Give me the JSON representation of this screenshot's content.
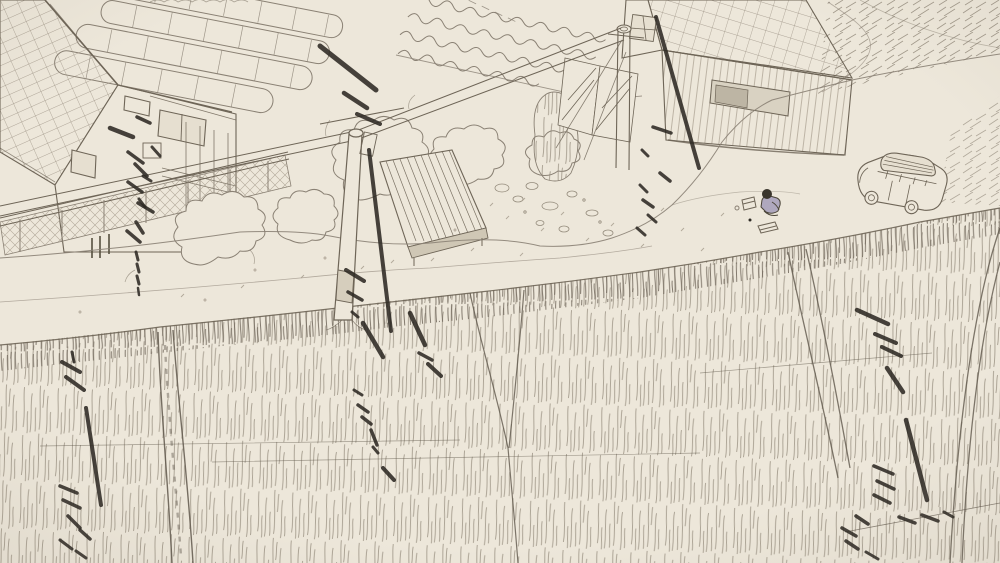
{
  "scene": {
    "style": "monochrome pencil sketch, aerial three-quarter view",
    "objects": [
      "farmhouse-with-tiled-roof",
      "greenhouse-tunnels",
      "vegetable-garden",
      "chain-link-fence",
      "trees",
      "utility-pole-center",
      "utility-pole-right",
      "power-lines",
      "plank-sided-house",
      "wooden-shed",
      "gravel-road",
      "parked-car",
      "sitting-person",
      "rice-fields",
      "dry-field",
      "cicada-sound-marks"
    ]
  },
  "palette": {
    "paper": "#ede7da",
    "ink": "#8a8174",
    "ink_soft": "#a79d8e",
    "ink_dark": "#6e6557",
    "ink_bold": "#2e2a24",
    "figure_accent": "#7b74a8"
  },
  "sound_marks": [
    {
      "x1": 320,
      "y1": 46,
      "x2": 376,
      "y2": 90,
      "w": 5
    },
    {
      "x1": 344,
      "y1": 93,
      "x2": 367,
      "y2": 108,
      "w": 4.5
    },
    {
      "x1": 357,
      "y1": 114,
      "x2": 380,
      "y2": 124,
      "w": 4
    },
    {
      "x1": 369,
      "y1": 150,
      "x2": 391,
      "y2": 331,
      "w": 4
    },
    {
      "x1": 346,
      "y1": 270,
      "x2": 364,
      "y2": 281,
      "w": 4
    },
    {
      "x1": 348,
      "y1": 292,
      "x2": 362,
      "y2": 300,
      "w": 3.5
    },
    {
      "x1": 352,
      "y1": 312,
      "x2": 358,
      "y2": 317,
      "w": 3
    },
    {
      "x1": 110,
      "y1": 128,
      "x2": 133,
      "y2": 137,
      "w": 4.5
    },
    {
      "x1": 137,
      "y1": 117,
      "x2": 150,
      "y2": 123,
      "w": 3.5
    },
    {
      "x1": 128,
      "y1": 152,
      "x2": 143,
      "y2": 163,
      "w": 3.5
    },
    {
      "x1": 152,
      "y1": 147,
      "x2": 160,
      "y2": 156,
      "w": 3
    },
    {
      "x1": 135,
      "y1": 164,
      "x2": 147,
      "y2": 176,
      "w": 3.5
    },
    {
      "x1": 143,
      "y1": 176,
      "x2": 151,
      "y2": 181,
      "w": 3
    },
    {
      "x1": 128,
      "y1": 182,
      "x2": 142,
      "y2": 192,
      "w": 3.5
    },
    {
      "x1": 139,
      "y1": 199,
      "x2": 145,
      "y2": 207,
      "w": 3
    },
    {
      "x1": 138,
      "y1": 203,
      "x2": 153,
      "y2": 212,
      "w": 3.5
    },
    {
      "x1": 136,
      "y1": 222,
      "x2": 143,
      "y2": 233,
      "w": 3.5
    },
    {
      "x1": 127,
      "y1": 231,
      "x2": 140,
      "y2": 242,
      "w": 3.5
    },
    {
      "x1": 136,
      "y1": 252,
      "x2": 138,
      "y2": 260,
      "w": 3
    },
    {
      "x1": 137,
      "y1": 264,
      "x2": 139,
      "y2": 272,
      "w": 3
    },
    {
      "x1": 137,
      "y1": 276,
      "x2": 139,
      "y2": 284,
      "w": 3
    },
    {
      "x1": 138,
      "y1": 288,
      "x2": 139,
      "y2": 295,
      "w": 2.5
    },
    {
      "x1": 656,
      "y1": 17,
      "x2": 699,
      "y2": 168,
      "w": 4
    },
    {
      "x1": 653,
      "y1": 127,
      "x2": 671,
      "y2": 133,
      "w": 3.5
    },
    {
      "x1": 642,
      "y1": 150,
      "x2": 648,
      "y2": 156,
      "w": 3
    },
    {
      "x1": 660,
      "y1": 173,
      "x2": 670,
      "y2": 181,
      "w": 3.5
    },
    {
      "x1": 640,
      "y1": 185,
      "x2": 647,
      "y2": 192,
      "w": 3
    },
    {
      "x1": 643,
      "y1": 200,
      "x2": 653,
      "y2": 207,
      "w": 3.5
    },
    {
      "x1": 648,
      "y1": 215,
      "x2": 656,
      "y2": 222,
      "w": 3
    },
    {
      "x1": 637,
      "y1": 228,
      "x2": 645,
      "y2": 235,
      "w": 3
    },
    {
      "x1": 363,
      "y1": 323,
      "x2": 383,
      "y2": 357,
      "w": 4.5
    },
    {
      "x1": 410,
      "y1": 313,
      "x2": 425,
      "y2": 345,
      "w": 4.5
    },
    {
      "x1": 419,
      "y1": 353,
      "x2": 432,
      "y2": 360,
      "w": 3.5
    },
    {
      "x1": 428,
      "y1": 364,
      "x2": 441,
      "y2": 376,
      "w": 4
    },
    {
      "x1": 354,
      "y1": 390,
      "x2": 362,
      "y2": 395,
      "w": 3
    },
    {
      "x1": 358,
      "y1": 405,
      "x2": 368,
      "y2": 412,
      "w": 3.5
    },
    {
      "x1": 362,
      "y1": 417,
      "x2": 371,
      "y2": 424,
      "w": 3.5
    },
    {
      "x1": 371,
      "y1": 430,
      "x2": 377,
      "y2": 445,
      "w": 3.5
    },
    {
      "x1": 373,
      "y1": 447,
      "x2": 378,
      "y2": 453,
      "w": 3
    },
    {
      "x1": 383,
      "y1": 468,
      "x2": 394,
      "y2": 480,
      "w": 4
    },
    {
      "x1": 62,
      "y1": 362,
      "x2": 80,
      "y2": 372,
      "w": 4
    },
    {
      "x1": 66,
      "y1": 377,
      "x2": 84,
      "y2": 390,
      "w": 4
    },
    {
      "x1": 72,
      "y1": 352,
      "x2": 74,
      "y2": 362,
      "w": 3
    },
    {
      "x1": 86,
      "y1": 408,
      "x2": 101,
      "y2": 505,
      "w": 4
    },
    {
      "x1": 60,
      "y1": 486,
      "x2": 77,
      "y2": 493,
      "w": 3.5
    },
    {
      "x1": 63,
      "y1": 500,
      "x2": 80,
      "y2": 508,
      "w": 3.5
    },
    {
      "x1": 68,
      "y1": 516,
      "x2": 80,
      "y2": 528,
      "w": 3.5
    },
    {
      "x1": 80,
      "y1": 530,
      "x2": 90,
      "y2": 539,
      "w": 3.5
    },
    {
      "x1": 60,
      "y1": 540,
      "x2": 72,
      "y2": 549,
      "w": 3
    },
    {
      "x1": 76,
      "y1": 551,
      "x2": 86,
      "y2": 558,
      "w": 3
    },
    {
      "x1": 857,
      "y1": 310,
      "x2": 888,
      "y2": 324,
      "w": 4.5
    },
    {
      "x1": 875,
      "y1": 334,
      "x2": 896,
      "y2": 343,
      "w": 4
    },
    {
      "x1": 882,
      "y1": 347,
      "x2": 901,
      "y2": 356,
      "w": 4
    },
    {
      "x1": 887,
      "y1": 368,
      "x2": 903,
      "y2": 392,
      "w": 4.5
    },
    {
      "x1": 906,
      "y1": 420,
      "x2": 927,
      "y2": 500,
      "w": 4.5
    },
    {
      "x1": 874,
      "y1": 466,
      "x2": 893,
      "y2": 474,
      "w": 3.5
    },
    {
      "x1": 877,
      "y1": 481,
      "x2": 894,
      "y2": 489,
      "w": 3.5
    },
    {
      "x1": 874,
      "y1": 495,
      "x2": 890,
      "y2": 503,
      "w": 3.5
    },
    {
      "x1": 856,
      "y1": 516,
      "x2": 868,
      "y2": 524,
      "w": 3.5
    },
    {
      "x1": 842,
      "y1": 528,
      "x2": 856,
      "y2": 536,
      "w": 3.5
    },
    {
      "x1": 846,
      "y1": 541,
      "x2": 858,
      "y2": 549,
      "w": 3.5
    },
    {
      "x1": 866,
      "y1": 552,
      "x2": 878,
      "y2": 559,
      "w": 3
    },
    {
      "x1": 899,
      "y1": 517,
      "x2": 915,
      "y2": 523,
      "w": 3.5
    },
    {
      "x1": 922,
      "y1": 515,
      "x2": 938,
      "y2": 521,
      "w": 3.5
    },
    {
      "x1": 944,
      "y1": 512,
      "x2": 953,
      "y2": 517,
      "w": 3
    }
  ]
}
